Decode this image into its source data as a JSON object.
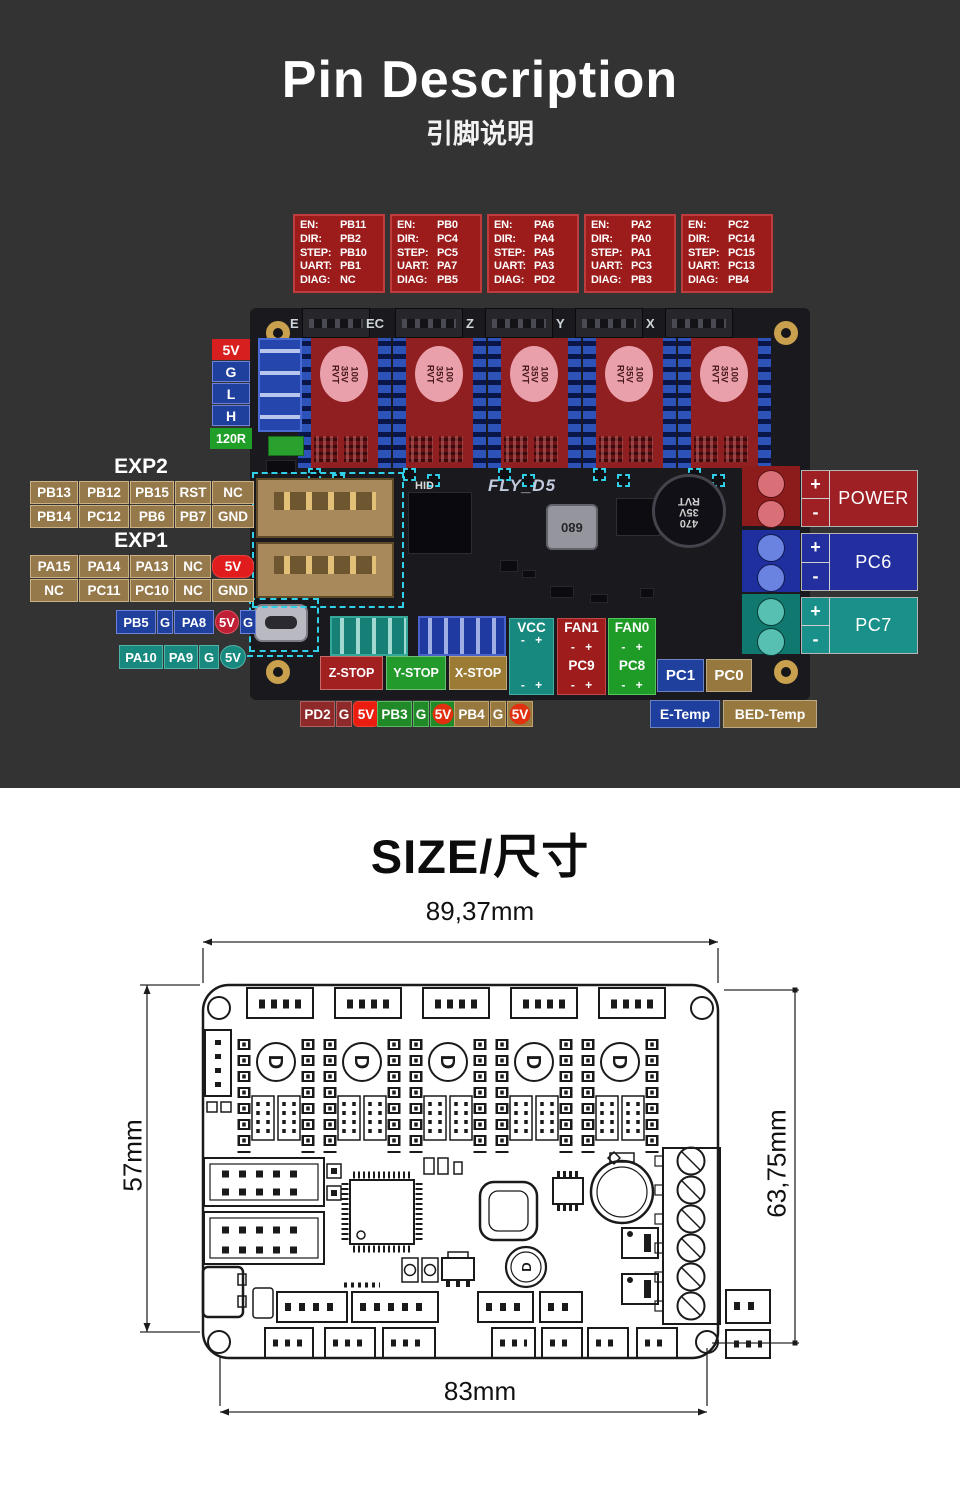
{
  "pin_section": {
    "title": "Pin Description",
    "subtitle": "引脚说明",
    "board": {
      "silkscreen": "FLY_D5",
      "hid": "HID",
      "ports": [
        "E",
        "EC",
        "Z",
        "Y",
        "X"
      ],
      "cap_lines": [
        "100",
        "35V",
        "RVT"
      ],
      "main_cap_lines": [
        "470",
        "35V",
        "RVT"
      ],
      "inductor": "680"
    },
    "pinout_keys": [
      "EN:",
      "DIR:",
      "STEP:",
      "UART:",
      "DIAG:"
    ],
    "drivers": [
      {
        "en": "PB11",
        "dir": "PB2",
        "step": "PB10",
        "uart": "PB1",
        "diag": "NC"
      },
      {
        "en": "PB0",
        "dir": "PC4",
        "step": "PC5",
        "uart": "PA7",
        "diag": "PB5"
      },
      {
        "en": "PA6",
        "dir": "PA4",
        "step": "PA5",
        "uart": "PA3",
        "diag": "PD2"
      },
      {
        "en": "PA2",
        "dir": "PA0",
        "step": "PA1",
        "uart": "PC3",
        "diag": "PB3"
      },
      {
        "en": "PC2",
        "dir": "PC14",
        "step": "PC15",
        "uart": "PC13",
        "diag": "PB4"
      }
    ],
    "levels": [
      "5V",
      "G",
      "L",
      "H"
    ],
    "terminator": "120R",
    "exp2": {
      "title": "EXP2",
      "row1": [
        "PB13",
        "PB12",
        "PB15",
        "RST",
        "NC"
      ],
      "row2": [
        "PB14",
        "PC12",
        "PB6",
        "PB7",
        "GND"
      ]
    },
    "exp1": {
      "title": "EXP1",
      "row1": [
        "PA15",
        "PA14",
        "PA13",
        "NC",
        "5V"
      ],
      "row2": [
        "NC",
        "PC11",
        "PC10",
        "NC",
        "GND"
      ]
    },
    "probe_blue": [
      "PB5",
      "G",
      "PA8",
      "5V",
      "G"
    ],
    "probe_teal": [
      "PA10",
      "PA9",
      "G",
      "5V"
    ],
    "endstops": [
      "Z-STOP",
      "Y-STOP",
      "X-STOP"
    ],
    "polarity": "- +",
    "vcc_header": "VCC",
    "fan1_header": "FAN1",
    "fan0_header": "FAN0",
    "pc9": "PC9",
    "pc8": "PC8",
    "temp_headers": [
      [
        "PD2",
        "G",
        "5V"
      ],
      [
        "PB3",
        "G",
        "5V"
      ],
      [
        "PB4",
        "G",
        "5V"
      ]
    ],
    "pc1": "PC1",
    "pc0": "PC0",
    "etemp": "E-Temp",
    "bedtemp": "BED-Temp",
    "terminals": [
      {
        "plus": "+",
        "minus": "-",
        "label": "POWER"
      },
      {
        "plus": "+",
        "minus": "-",
        "label": "PC6"
      },
      {
        "plus": "+",
        "minus": "-",
        "label": "PC7"
      }
    ]
  },
  "size_section": {
    "title": "SIZE/尺寸",
    "dim_width_top": "89,37mm",
    "dim_height_left": "57mm",
    "dim_height_right": "63,75mm",
    "dim_width_bottom": "83mm",
    "cap_letter": "D"
  },
  "colors": {
    "background_dark": "#333333",
    "annotation_red": "#9c1b1b",
    "bright_red": "#e01c1c",
    "blue": "#20409e",
    "teal": "#18897f",
    "green": "#1f9b28",
    "tan": "#97793f",
    "power_red": "#9e2025",
    "pc6_blue": "#232f9e",
    "pc7_teal": "#19918a",
    "cyan_dash": "#2fd0e8"
  }
}
